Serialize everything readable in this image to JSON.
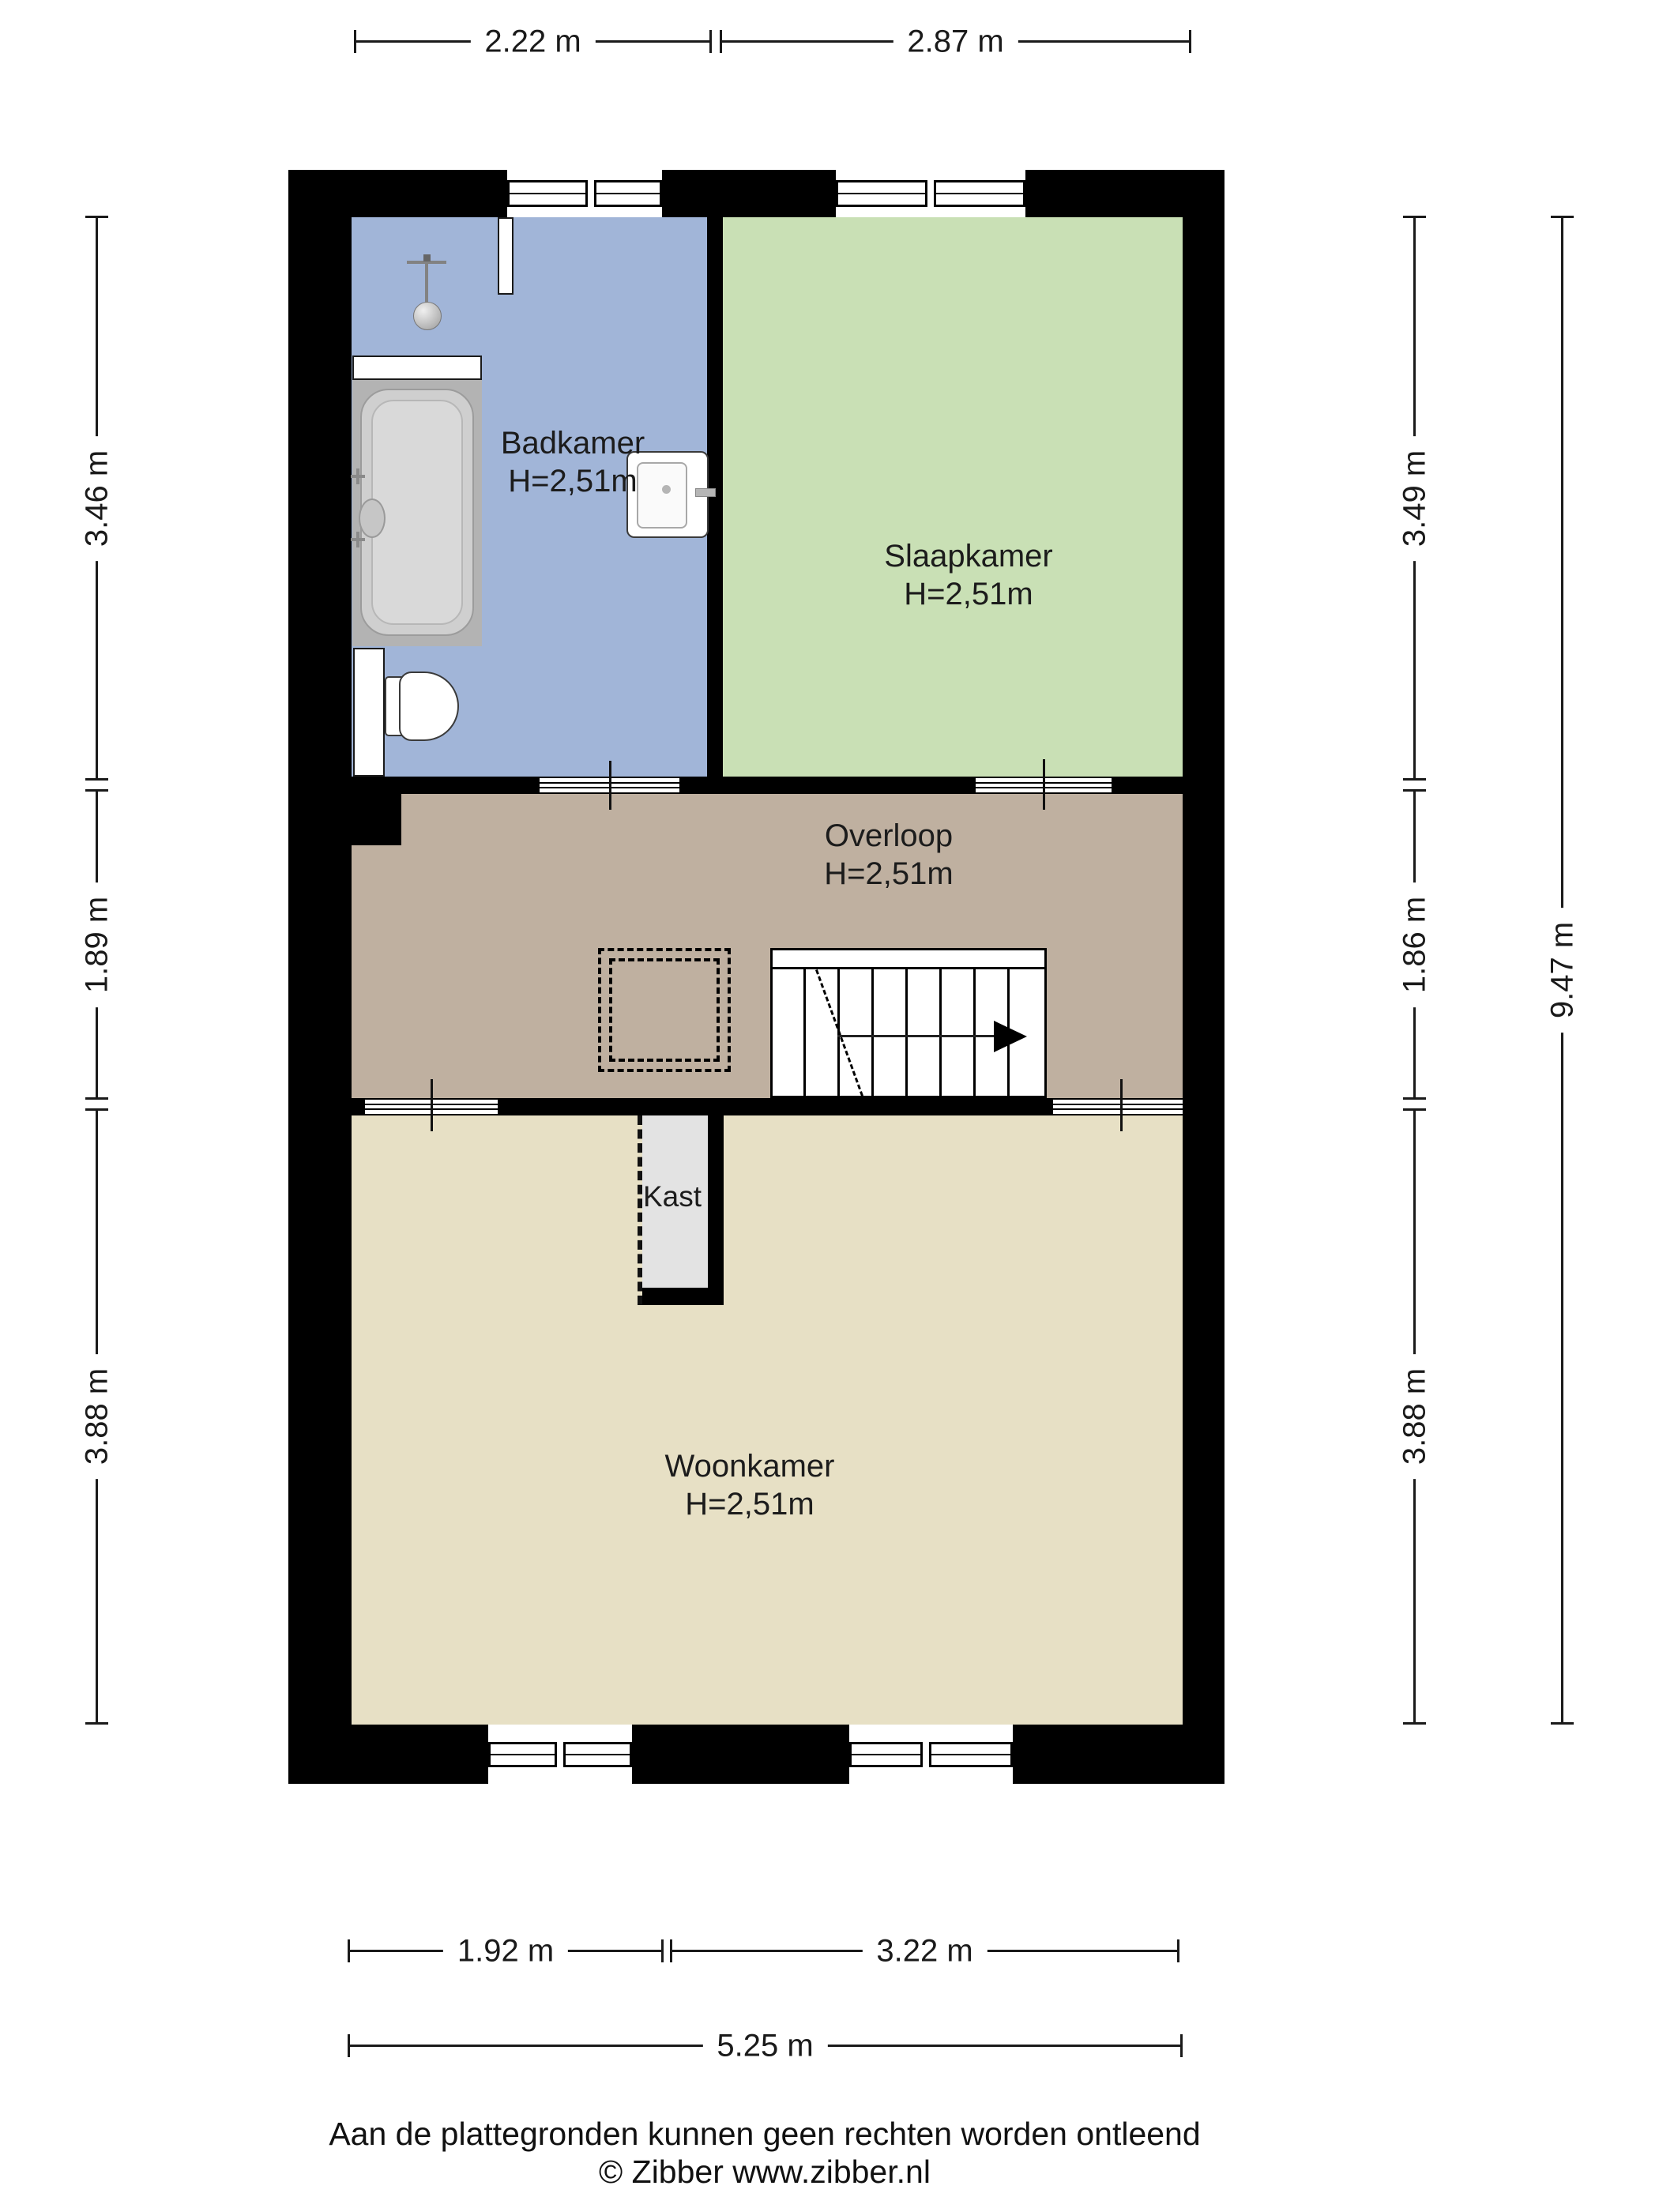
{
  "document": {
    "type": "floor-plan",
    "language": "nl"
  },
  "rooms": {
    "badkamer": {
      "name": "Badkamer",
      "height": "H=2,51m"
    },
    "slaapkamer": {
      "name": "Slaapkamer",
      "height": "H=2,51m"
    },
    "overloop": {
      "name": "Overloop",
      "height": "H=2,51m"
    },
    "woonkamer": {
      "name": "Woonkamer",
      "height": "H=2,51m"
    },
    "kast": {
      "name": "Kast"
    }
  },
  "dimensions": {
    "top": {
      "left": "2.22 m",
      "right": "2.87 m"
    },
    "bottom": {
      "left": "1.92 m",
      "right": "3.22 m",
      "total": "5.25 m"
    },
    "left": {
      "top": "3.46 m",
      "middle": "1.89 m",
      "bottom": "3.88 m"
    },
    "right": {
      "top": "3.49 m",
      "middle": "1.86 m",
      "bottom": "3.88 m",
      "total": "9.47 m"
    }
  },
  "footer": {
    "line1": "Aan de plattegronden kunnen geen rechten worden ontleend",
    "line2": "© Zibber www.zibber.nl"
  },
  "colors": {
    "wall": "#000000",
    "badkamer_floor": "#a1b5d8",
    "slaapkamer_floor": "#c9e0b5",
    "overloop_floor": "#bfb0a0",
    "woonkamer_floor": "#e7e0c5",
    "kast_floor": "#e3e3e3",
    "dimension_lines": "#1a1a1a"
  },
  "icons": {
    "bathtub": "bathtub-icon",
    "shower": "shower-head-icon",
    "toilet": "toilet-icon",
    "sink": "sink-icon",
    "stairs": "staircase-icon",
    "stairs_arrow": "stairs-direction-arrow-icon",
    "ceiling_hatch": "ceiling-hatch-icon"
  }
}
